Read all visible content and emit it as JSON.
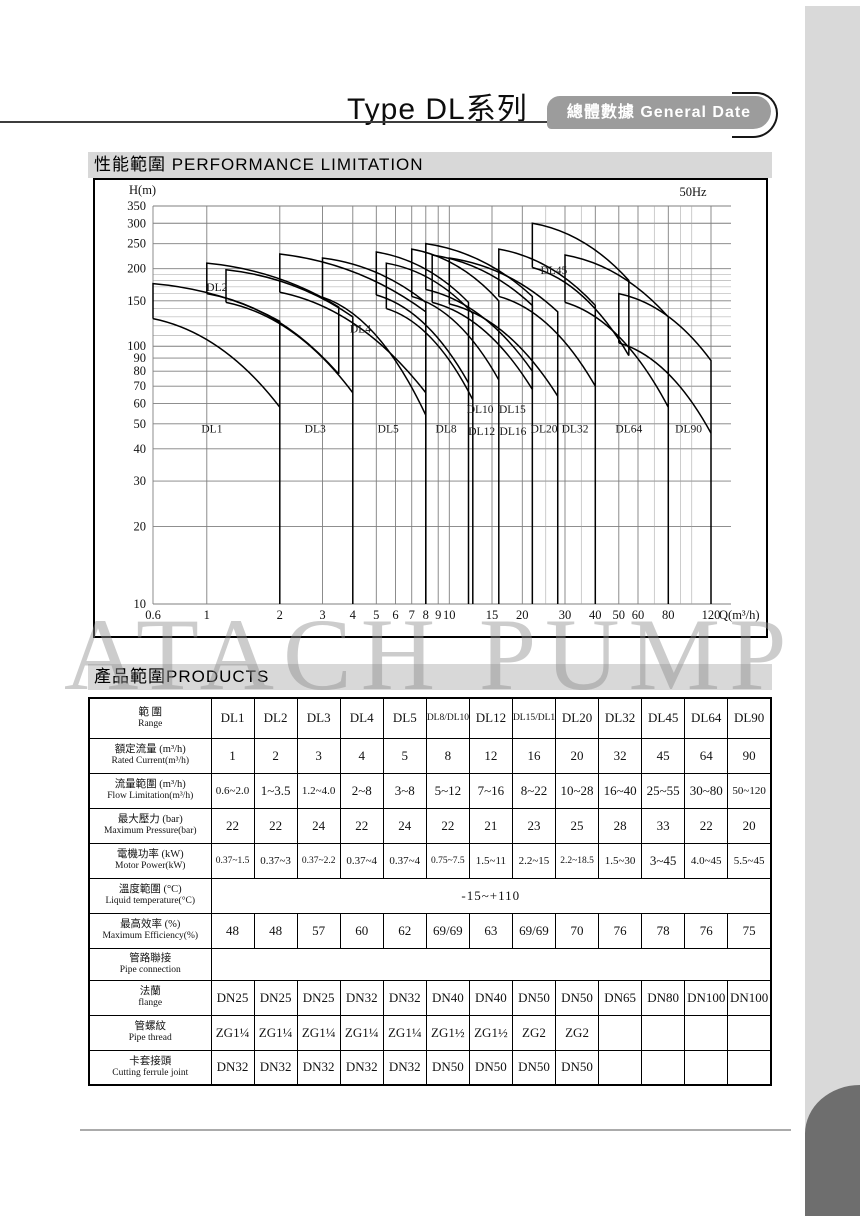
{
  "header": {
    "title": "Type DL系列",
    "badge": "總體數據 General Date"
  },
  "sections": {
    "performance": "性能範圍 PERFORMANCE LIMITATION",
    "products": "產品範圍PRODUCTS"
  },
  "watermark": "ATACH PUMP",
  "chart_data": {
    "type": "line",
    "title": "性能範圍 PERFORMANCE LIMITATION",
    "xlabel": "Q(m³/h)",
    "ylabel": "H(m)",
    "freq_label": "50Hz",
    "scale": "log-log",
    "xlim": [
      0.6,
      120
    ],
    "ylim": [
      10,
      350
    ],
    "x_ticks": [
      0.6,
      1,
      2,
      3,
      4,
      5,
      6,
      7,
      8,
      9,
      10,
      15,
      20,
      30,
      40,
      50,
      60,
      80,
      120
    ],
    "x_minor": [
      25,
      35,
      70,
      90,
      100
    ],
    "y_ticks": [
      10,
      20,
      30,
      40,
      50,
      60,
      70,
      80,
      90,
      100,
      150,
      200,
      250,
      300,
      350
    ],
    "y_minor": [
      110,
      120,
      130,
      140,
      160,
      170,
      180,
      190
    ],
    "grid": true,
    "series": [
      {
        "name": "DL1",
        "q": [
          0.6,
          2
        ],
        "h_upper": [
          175,
          125
        ],
        "h_lower": [
          128,
          58
        ],
        "full_drop": true
      },
      {
        "name": "DL2",
        "q": [
          1,
          3.5
        ],
        "h_upper": [
          210,
          142
        ],
        "h_lower": [
          160,
          78
        ],
        "full_drop": false
      },
      {
        "name": "DL3",
        "q": [
          1.2,
          4
        ],
        "h_upper": [
          198,
          130
        ],
        "h_lower": [
          148,
          66
        ],
        "full_drop": true
      },
      {
        "name": "DL4",
        "q": [
          2,
          8
        ],
        "h_upper": [
          228,
          136
        ],
        "h_lower": [
          162,
          66
        ],
        "full_drop": true
      },
      {
        "name": "DL5",
        "q": [
          3,
          8
        ],
        "h_upper": [
          220,
          148
        ],
        "h_lower": [
          155,
          54
        ],
        "full_drop": true
      },
      {
        "name": "DL8",
        "q": [
          5,
          12
        ],
        "h_upper": [
          232,
          148
        ],
        "h_lower": [
          158,
          72
        ],
        "full_drop": true
      },
      {
        "name": "DL10",
        "q": [
          5.5,
          12.5
        ],
        "h_upper": [
          210,
          134
        ],
        "h_lower": [
          140,
          62
        ],
        "full_drop": true
      },
      {
        "name": "DL12",
        "q": [
          7,
          16
        ],
        "h_upper": [
          238,
          150
        ],
        "h_lower": [
          156,
          74
        ],
        "full_drop": true
      },
      {
        "name": "DL15",
        "q": [
          8,
          22
        ],
        "h_upper": [
          250,
          156
        ],
        "h_lower": [
          166,
          80
        ],
        "full_drop": true
      },
      {
        "name": "DL16",
        "q": [
          8.5,
          22
        ],
        "h_upper": [
          226,
          144
        ],
        "h_lower": [
          148,
          68
        ],
        "full_drop": false
      },
      {
        "name": "DL20",
        "q": [
          10,
          28
        ],
        "h_upper": [
          220,
          136
        ],
        "h_lower": [
          146,
          64
        ],
        "full_drop": true
      },
      {
        "name": "DL32",
        "q": [
          16,
          40
        ],
        "h_upper": [
          238,
          144
        ],
        "h_lower": [
          156,
          70
        ],
        "full_drop": true
      },
      {
        "name": "DL45",
        "q": [
          22,
          55
        ],
        "h_upper": [
          300,
          180
        ],
        "h_lower": [
          202,
          92
        ],
        "full_drop": false
      },
      {
        "name": "DL64",
        "q": [
          30,
          80
        ],
        "h_upper": [
          226,
          130
        ],
        "h_lower": [
          148,
          58
        ],
        "full_drop": true
      },
      {
        "name": "DL90",
        "q": [
          50,
          120
        ],
        "h_upper": [
          160,
          88
        ],
        "h_lower": [
          103,
          46
        ],
        "full_drop": true
      }
    ],
    "labels": [
      {
        "text": "DL2",
        "q": 1.1,
        "h": 170
      },
      {
        "text": "DL4",
        "q": 4.3,
        "h": 117
      },
      {
        "text": "DL45",
        "q": 27,
        "h": 198
      },
      {
        "text": "DL1",
        "q": 1.05,
        "h": 48
      },
      {
        "text": "DL3",
        "q": 2.8,
        "h": 48
      },
      {
        "text": "DL5",
        "q": 5.6,
        "h": 48
      },
      {
        "text": "DL8",
        "q": 9.7,
        "h": 48
      },
      {
        "text": "DL10",
        "q": 13.4,
        "h": 57
      },
      {
        "text": "DL12",
        "q": 13.6,
        "h": 47
      },
      {
        "text": "DL15",
        "q": 18.2,
        "h": 57
      },
      {
        "text": "DL16",
        "q": 18.3,
        "h": 47
      },
      {
        "text": "DL20",
        "q": 24.6,
        "h": 48
      },
      {
        "text": "DL32",
        "q": 33,
        "h": 48
      },
      {
        "text": "DL64",
        "q": 55,
        "h": 48
      },
      {
        "text": "DL90",
        "q": 97,
        "h": 48
      }
    ]
  },
  "table": {
    "header_row": {
      "zh": "範 圍",
      "en": "Range",
      "cols": [
        "DL1",
        "DL2",
        "DL3",
        "DL4",
        "DL5",
        "DL8/DL10",
        "DL12",
        "DL15/DL16",
        "DL20",
        "DL32",
        "DL45",
        "DL64",
        "DL90"
      ]
    },
    "rows": [
      {
        "zh": "額定流量 (m³/h)",
        "en": "Rated Current(m³/h)",
        "values": [
          "1",
          "2",
          "3",
          "4",
          "5",
          "8",
          "12",
          "16",
          "20",
          "32",
          "45",
          "64",
          "90"
        ]
      },
      {
        "zh": "流量範圍 (m³/h)",
        "en": "Flow Limitation(m³/h)",
        "values": [
          "0.6~2.0",
          "1~3.5",
          "1.2~4.0",
          "2~8",
          "3~8",
          "5~12",
          "7~16",
          "8~22",
          "10~28",
          "16~40",
          "25~55",
          "30~80",
          "50~120"
        ]
      },
      {
        "zh": "最大壓力 (bar)",
        "en": "Maximum Pressure(bar)",
        "values": [
          "22",
          "22",
          "24",
          "22",
          "24",
          "22",
          "21",
          "23",
          "25",
          "28",
          "33",
          "22",
          "20"
        ]
      },
      {
        "zh": "電機功率 (kW)",
        "en": "Motor Power(kW)",
        "values": [
          "0.37~1.5",
          "0.37~3",
          "0.37~2.2",
          "0.37~4",
          "0.37~4",
          "0.75~7.5",
          "1.5~11",
          "2.2~15",
          "2.2~18.5",
          "1.5~30",
          "3~45",
          "4.0~45",
          "5.5~45"
        ]
      },
      {
        "zh": "溫度範圍 (°C)",
        "en": "Liquid temperature(°C)",
        "span_value": "-15~+110"
      },
      {
        "zh": "最高效率 (%)",
        "en": "Maximum Efficiency(%)",
        "values": [
          "48",
          "48",
          "57",
          "60",
          "62",
          "69/69",
          "63",
          "69/69",
          "70",
          "76",
          "78",
          "76",
          "75"
        ]
      },
      {
        "zh": "管路聯接",
        "en": "Pipe connection",
        "span_value": ""
      },
      {
        "zh": "法蘭",
        "en": "flange",
        "values": [
          "DN25",
          "DN25",
          "DN25",
          "DN32",
          "DN32",
          "DN40",
          "DN40",
          "DN50",
          "DN50",
          "DN65",
          "DN80",
          "DN100",
          "DN100"
        ]
      },
      {
        "zh": "管螺紋",
        "en": "Pipe thread",
        "values": [
          "ZG1¼",
          "ZG1¼",
          "ZG1¼",
          "ZG1¼",
          "ZG1¼",
          "ZG1½",
          "ZG1½",
          "ZG2",
          "ZG2",
          "",
          "",
          "",
          ""
        ]
      },
      {
        "zh": "卡套接頭",
        "en": "Cutting ferrule joint",
        "values": [
          "DN32",
          "DN32",
          "DN32",
          "DN32",
          "DN32",
          "DN50",
          "DN50",
          "DN50",
          "DN50",
          "",
          "",
          "",
          ""
        ]
      }
    ]
  }
}
